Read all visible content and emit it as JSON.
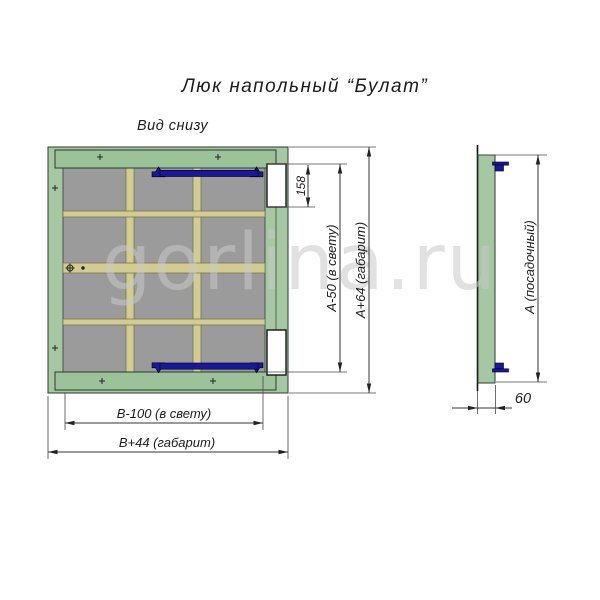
{
  "title": "Люк напольный “Булат”",
  "watermark": "gorlina.ru",
  "bottom_view": {
    "label": "Вид снизу",
    "dims": {
      "hinge_cutout_height": "158",
      "clear_height": "А-50 (в свету)",
      "overall_height": "А+64 (габарит)",
      "clear_width": "В-100 (в свету)",
      "overall_width": "В+44 (габарит)"
    }
  },
  "side_view": {
    "dims": {
      "seat_height": "А (посадочный)",
      "frame_depth": "60"
    }
  },
  "colors": {
    "frame_green": "#a5c8a2",
    "crossbar_green": "#9cc29a",
    "panel_gray": "#9b9b9b",
    "rib_khaki": "#d3cc92",
    "hinge_blue": "#1717a0",
    "outline_dark": "#2e3a2e",
    "dimension_line": "#333333",
    "text": "#1c1c1c",
    "watermark_gray": "#c9c9c9"
  }
}
